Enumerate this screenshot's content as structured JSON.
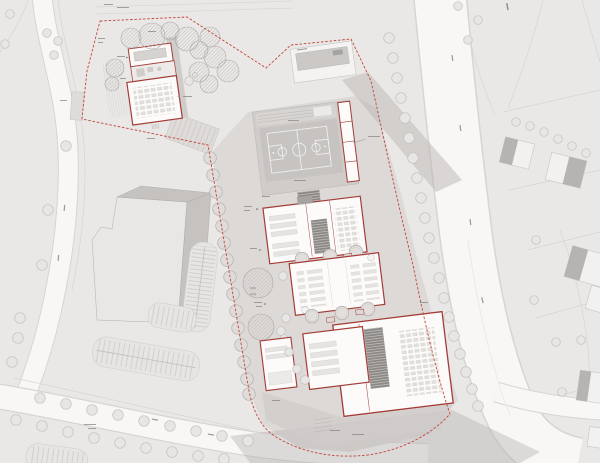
{
  "palette": {
    "background": "#eae8e6",
    "road_fill": "#f8f7f6",
    "road_edge": "#d7d4d2",
    "paving": "#dcd9d7",
    "paving_dark": "#cfccca",
    "building_fill": "#fcfbfa",
    "building_red": "#a33c37",
    "boundary_red": "#c2453a",
    "exist_fill": "#e9e7e5",
    "exist_roof": "#c5c2c0",
    "tree_fill": "#e8e6e4",
    "tree_ring": "#c3c0be",
    "hatch_gray": "#adaaa8",
    "core_dark": "#8b8886",
    "court_fill": "#c6c3c1",
    "court_line": "#f0efee",
    "shadow": "#b9b6b4",
    "annotation": "#8a8785",
    "house_fill": "#f2f1ef",
    "house_roof": "#b6b3b1"
  },
  "icons": {
    "tree-icon": "plain circle",
    "hatched-tree-icon": "diagonal-hatched circle",
    "campus-tree-icon": "double-ring circle",
    "basketball-court": "court outline with center circle and two keys",
    "parking-row": "rounded comb of stall stripes",
    "stair-core-icon": "dark rectangle with step lines",
    "site-boundary": "red dashed polyline",
    "micro-label": "illegible annotation mark"
  },
  "annotations_legible": false
}
